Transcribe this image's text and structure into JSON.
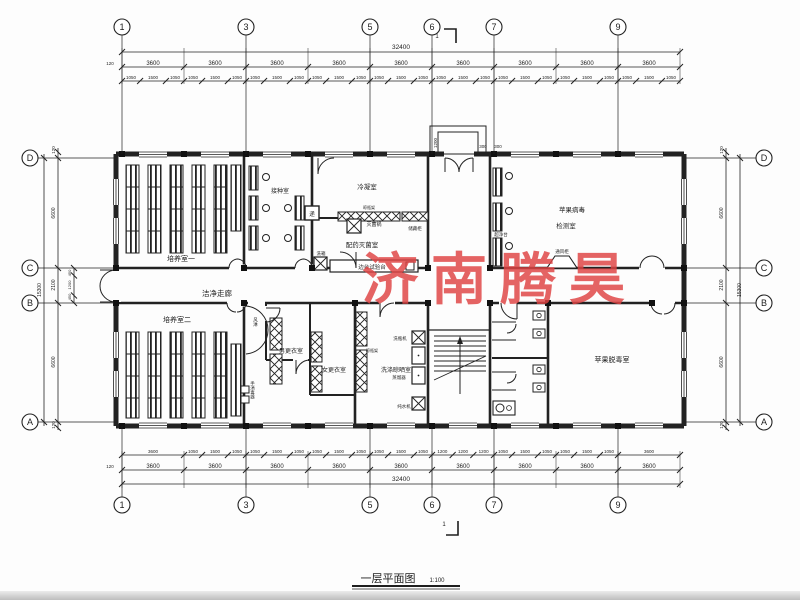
{
  "watermark": {
    "text": "济南腾昊",
    "color": "#e04444"
  },
  "title": {
    "name": "一层平面图",
    "scale": "1:100"
  },
  "section_mark": {
    "top": "1",
    "bottom": "1"
  },
  "grid": {
    "top": [
      "1",
      "3",
      "5",
      "6",
      "7",
      "9"
    ],
    "bottom": [
      "1",
      "3",
      "5",
      "6",
      "7",
      "9"
    ],
    "left": [
      "D",
      "C",
      "B",
      "A"
    ],
    "right": [
      "D",
      "C",
      "B",
      "A"
    ]
  },
  "dims": {
    "top_total": "32400",
    "bottom_total": "32400",
    "edge_left_top": "120",
    "edge_left_bottom": "120",
    "top_bays": [
      "3600",
      "3600",
      "3600",
      "3600",
      "3600",
      "3600",
      "3600",
      "3600",
      "3600"
    ],
    "top_sub": [
      [
        "1050",
        "1500",
        "1050"
      ],
      [
        "1050",
        "1500",
        "1050"
      ],
      [
        "1050",
        "1500",
        "1050"
      ],
      [
        "1050",
        "1500",
        "1050"
      ],
      [
        "1050",
        "1500",
        "1050"
      ],
      [
        "1050",
        "1500",
        "1050"
      ],
      [
        "1050",
        "1500",
        "1050"
      ],
      [
        "1050",
        "1500",
        "1050"
      ],
      [
        "1050",
        "1500",
        "1050"
      ]
    ],
    "bottom_bays": [
      "3600",
      "3600",
      "3600",
      "3600",
      "3600",
      "3600",
      "3600",
      "3600",
      "3600"
    ],
    "bottom_sub": [
      [
        "3600"
      ],
      [
        "1050",
        "1500",
        "1050"
      ],
      [
        "1050",
        "1500",
        "1050"
      ],
      [
        "1050",
        "1500",
        "1050"
      ],
      [
        "1050",
        "1500",
        "1050"
      ],
      [
        "1200",
        "1200",
        "1200"
      ],
      [
        "1050",
        "1500",
        "1050"
      ],
      [
        "1050",
        "1500",
        "1050"
      ],
      [
        "3600"
      ]
    ],
    "left": {
      "edge_top": "120",
      "d_c": "6600",
      "c_b": "2100",
      "b_a": "6600",
      "edge_bottom": "120",
      "total": "15300",
      "sub": [
        "450",
        "1200",
        "450"
      ]
    },
    "right": {
      "edge_top": "120",
      "d_c": "6600",
      "c_b": "2100",
      "b_a": "6600",
      "edge_bottom": "120",
      "total": "15300"
    },
    "entrance": {
      "depth": "1200",
      "a": "300",
      "b": "300"
    }
  },
  "rooms": {
    "cultivation1": "培养室一",
    "inoculation": "接种室",
    "condensation": "冷凝室",
    "prep_steril": "配药灭菌室",
    "virus_test_l1": "苹果病毒",
    "virus_test_l2": "检测室",
    "corridor": "洁净走廊",
    "cultivation2": "培养室二",
    "men_change": "男更衣室",
    "women_change": "女更衣室",
    "washing": "洗涤晾晒室",
    "detox": "苹果脱毒室"
  },
  "equipment": {
    "sterilizer": "灭菌锅",
    "storage": "储藏柜",
    "bench": "边台试验台",
    "washbox": "洗箱",
    "pass": "递",
    "cleanbench": "超净台",
    "fumehood": "通风柜",
    "airshower": "风淋",
    "handsanitizer": "手消毒器",
    "rack1": "晾瓶架",
    "rack2": "晾瓶架",
    "bottlewasher": "洗瓶机",
    "distiller": "蒸馏器",
    "purewater": "纯水机"
  }
}
